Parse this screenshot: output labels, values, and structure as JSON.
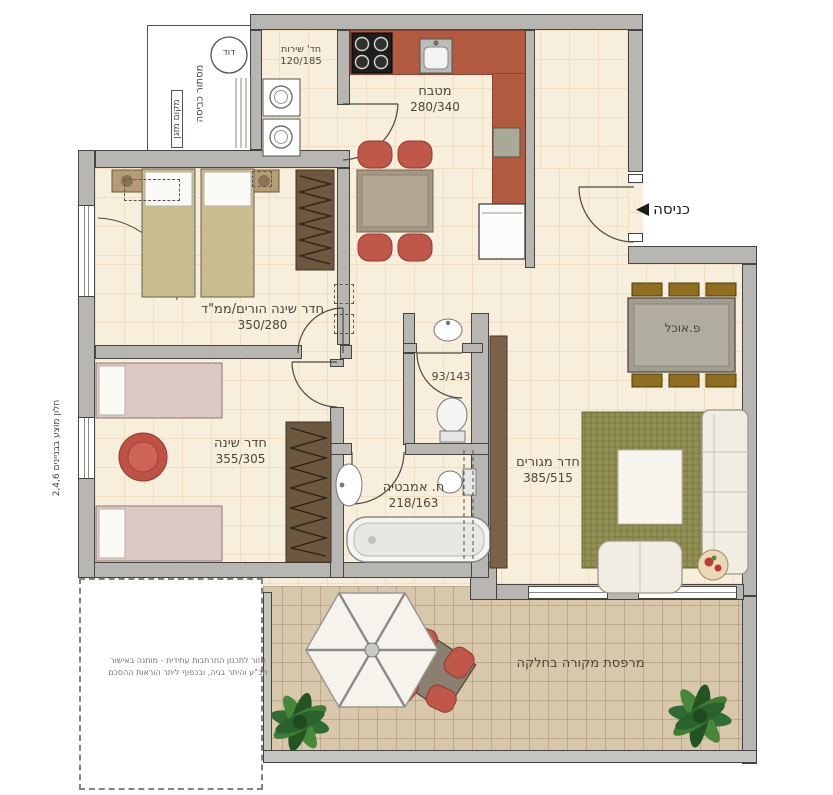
{
  "rooms": {
    "kitchen": {
      "name": "מטבח",
      "dims": "280/340"
    },
    "service": {
      "name": "חד' שירות",
      "dims": "120/185"
    },
    "parents": {
      "name": "חדר שינה הורים/ממ\"ד",
      "dims": "350/280"
    },
    "bedroom": {
      "name": "חדר שינה",
      "dims": "355/305"
    },
    "bath": {
      "name": "ח. אמבטיה",
      "dims": "218/163"
    },
    "wc": {
      "dims": "93/143"
    },
    "living": {
      "name": "חדר מגורים",
      "dims": "385/515"
    },
    "dining": {
      "name": "פ.אוכל"
    },
    "balcony": {
      "name": "מרפסת מקורה בחלקה"
    }
  },
  "annotations": {
    "entry": "כניסה",
    "entry_arrow": "◀",
    "boiler": "דוד",
    "laundry_screen": "מסתור כביסה",
    "ac_unit": "מקום מזגן",
    "window_note": "חלון מוצע בבניינים 2,4,6",
    "disclaimer_line1": "אזור לתכנון התרחבות עתידית - מותנה באישור",
    "disclaimer_line2": "תב\"ע והיתר בניה, ובכפוף ליתר הוראות ההסכם"
  },
  "colors": {
    "wall": "#b7b6b2",
    "floor": "#f7eedb",
    "counter_terracotta": "#b15a40",
    "balcony_tile": "#d9c7ac",
    "accent_red": "#c0584a",
    "wood_dark": "#6e573f",
    "rug_green": "#928f55"
  }
}
